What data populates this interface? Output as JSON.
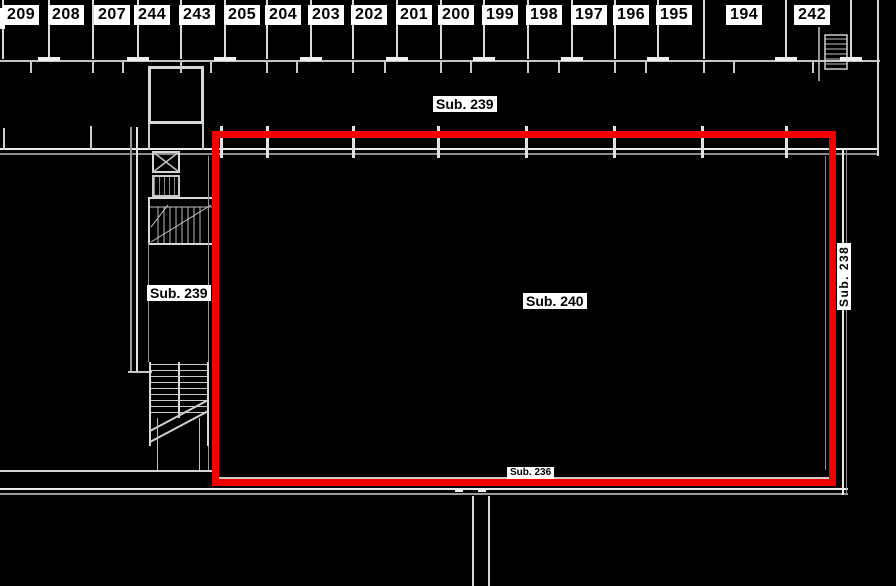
{
  "drawing": {
    "rooms": [
      "209",
      "208",
      "207",
      "244",
      "243",
      "205",
      "204",
      "203",
      "202",
      "201",
      "200",
      "199",
      "198",
      "197",
      "196",
      "195",
      "194",
      "242"
    ],
    "areas": {
      "top": "Sub. 239",
      "left": "Sub. 239",
      "main": "Sub. 240",
      "right_vertical": "Sub. 238",
      "bottom": "Sub. 236"
    },
    "colors": {
      "highlight": "#f20000",
      "background": "#000000",
      "line": "#e0e0e0"
    },
    "icons": {
      "elevator": "elevator-x-icon",
      "stairs_detail": "stairs-detail-icon",
      "stairs": "stairs-icon",
      "ladder": "ladder-icon"
    }
  }
}
